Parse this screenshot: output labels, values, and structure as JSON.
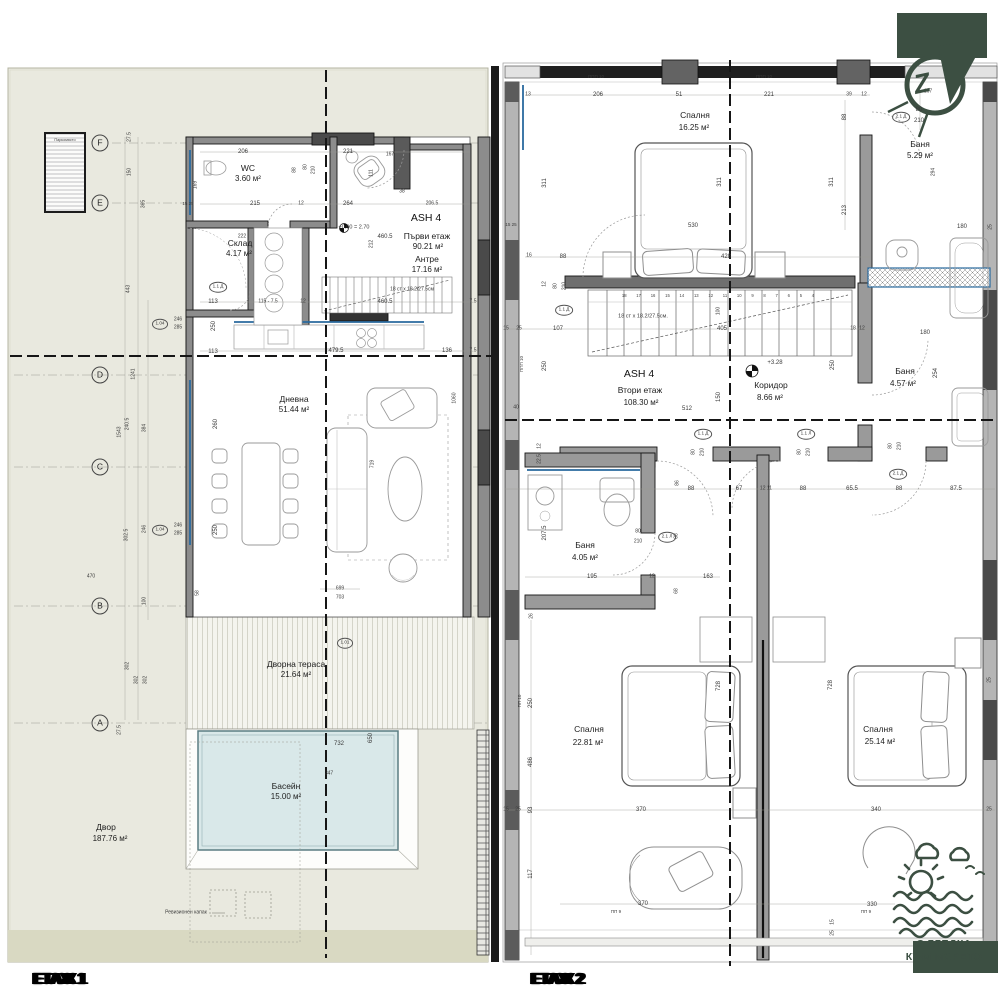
{
  "sheet": {
    "floor1_label": "ЕТАЖ 1",
    "floor2_label": "ЕТАЖ 2"
  },
  "badge": {
    "line1": "С ГЛЕДКА",
    "line2": "КЪМ МОРЕТО",
    "color": "#3c4f42"
  },
  "compass": {
    "letter": "Z",
    "nearby_dim": "167"
  },
  "left_plan": {
    "rooms": [
      {
        "t": "WC",
        "x": 248,
        "y": 168,
        "c": "room"
      },
      {
        "t": "3.60 м²",
        "x": 248,
        "y": 179,
        "c": "area"
      },
      {
        "t": "Склад",
        "x": 240,
        "y": 243,
        "c": "room"
      },
      {
        "t": "4.17 м²",
        "x": 239,
        "y": 254,
        "c": "area"
      },
      {
        "t": "ASH 4",
        "x": 426,
        "y": 218,
        "c": "big"
      },
      {
        "t": "Първи  етаж",
        "x": 427,
        "y": 236,
        "c": "room"
      },
      {
        "t": "90.21 м²",
        "x": 428,
        "y": 247,
        "c": "area"
      },
      {
        "t": "Антре",
        "x": 427,
        "y": 259,
        "c": "room"
      },
      {
        "t": "17.16 м²",
        "x": 427,
        "y": 270,
        "c": "area"
      },
      {
        "t": "Дневна",
        "x": 294,
        "y": 399,
        "c": "room"
      },
      {
        "t": "51.44 м²",
        "x": 294,
        "y": 410,
        "c": "area"
      },
      {
        "t": "Дворна тераса",
        "x": 296,
        "y": 664,
        "c": "room"
      },
      {
        "t": "21.64 м²",
        "x": 296,
        "y": 675,
        "c": "area"
      },
      {
        "t": "Басейн",
        "x": 286,
        "y": 786,
        "c": "room"
      },
      {
        "t": "15.00 м²",
        "x": 286,
        "y": 797,
        "c": "area"
      },
      {
        "t": "Двор",
        "x": 106,
        "y": 827,
        "c": "room"
      },
      {
        "t": "187.76 м²",
        "x": 110,
        "y": 839,
        "c": "area"
      },
      {
        "t": "Паркомясто",
        "x": 65,
        "y": 141,
        "s": 3.8
      },
      {
        "t": "+0.00 = 2.70",
        "x": 354,
        "y": 228,
        "s": 5.5
      },
      {
        "t": "18 ст x 18.2/27.5см",
        "x": 412,
        "y": 290,
        "s": 5
      },
      {
        "t": "Ревизионен капак",
        "x": 186,
        "y": 913,
        "s": 5
      }
    ],
    "dims": [
      {
        "t": "206",
        "x": 243,
        "y": 152
      },
      {
        "t": "167",
        "x": 390,
        "y": 155,
        "s": 5
      },
      {
        "t": "221",
        "x": 348,
        "y": 152
      },
      {
        "t": "215",
        "x": 255,
        "y": 204
      },
      {
        "t": "12",
        "x": 301,
        "y": 204,
        "s": 5
      },
      {
        "t": "264",
        "x": 348,
        "y": 204
      },
      {
        "t": "206.5",
        "x": 432,
        "y": 204,
        "s": 5
      },
      {
        "t": "38",
        "x": 402,
        "y": 192,
        "s": 5
      },
      {
        "t": "460.5",
        "x": 385,
        "y": 237
      },
      {
        "t": "212",
        "x": 372,
        "y": 244,
        "r": 90,
        "s": 5
      },
      {
        "t": "222",
        "x": 242,
        "y": 237,
        "s": 5
      },
      {
        "t": "113",
        "x": 213,
        "y": 302
      },
      {
        "t": "115 - 7.5",
        "x": 268,
        "y": 302,
        "s": 5
      },
      {
        "t": "12",
        "x": 303,
        "y": 302,
        "s": 5
      },
      {
        "t": "460.5",
        "x": 385,
        "y": 302
      },
      {
        "t": "113",
        "x": 213,
        "y": 352
      },
      {
        "t": "479.5",
        "x": 336,
        "y": 351
      },
      {
        "t": "136",
        "x": 447,
        "y": 351
      },
      {
        "t": "7.5",
        "x": 473,
        "y": 302,
        "s": 5
      },
      {
        "t": "7.5",
        "x": 473,
        "y": 351,
        "s": 5
      },
      {
        "t": "250",
        "x": 214,
        "y": 326,
        "r": 90
      },
      {
        "t": "699",
        "x": 340,
        "y": 589,
        "s": 5
      },
      {
        "t": "703",
        "x": 340,
        "y": 598,
        "s": 5
      },
      {
        "t": "260",
        "x": 216,
        "y": 424,
        "r": 90
      },
      {
        "t": "250",
        "x": 216,
        "y": 530,
        "r": 90
      },
      {
        "t": "719",
        "x": 373,
        "y": 464,
        "r": 90,
        "s": 5
      },
      {
        "t": "1060",
        "x": 455,
        "y": 398,
        "r": 90,
        "s": 5
      },
      {
        "t": "58",
        "x": 198,
        "y": 593,
        "r": 90,
        "s": 5
      },
      {
        "t": "732",
        "x": 339,
        "y": 744
      },
      {
        "t": "650",
        "x": 371,
        "y": 738,
        "r": 90
      },
      {
        "t": "347",
        "x": 329,
        "y": 774,
        "s": 5
      },
      {
        "t": "302",
        "x": 128,
        "y": 666,
        "r": 90,
        "s": 5
      },
      {
        "t": "302",
        "x": 137,
        "y": 680,
        "r": 90,
        "s": 5
      },
      {
        "t": "302",
        "x": 146,
        "y": 680,
        "r": 90,
        "s": 5
      },
      {
        "t": "470",
        "x": 91,
        "y": 577,
        "s": 5
      },
      {
        "t": "27.5",
        "x": 130,
        "y": 137,
        "r": 90,
        "s": 5
      },
      {
        "t": "150",
        "x": 130,
        "y": 172,
        "r": 90,
        "s": 5
      },
      {
        "t": "365",
        "x": 144,
        "y": 204,
        "r": 90,
        "s": 5
      },
      {
        "t": "443",
        "x": 129,
        "y": 289,
        "r": 90,
        "s": 5
      },
      {
        "t": "1241",
        "x": 134,
        "y": 374,
        "r": 90,
        "s": 5
      },
      {
        "t": "1543",
        "x": 120,
        "y": 432,
        "r": 90,
        "s": 5
      },
      {
        "t": "240.5",
        "x": 128,
        "y": 424,
        "r": 90,
        "s": 5
      },
      {
        "t": "384",
        "x": 145,
        "y": 428,
        "r": 90,
        "s": 5
      },
      {
        "t": "302.5",
        "x": 127,
        "y": 535,
        "r": 90,
        "s": 5
      },
      {
        "t": "246",
        "x": 145,
        "y": 529,
        "r": 90,
        "s": 5
      },
      {
        "t": "100",
        "x": 145,
        "y": 601,
        "r": 90,
        "s": 5
      },
      {
        "t": "246",
        "x": 178,
        "y": 320,
        "s": 5
      },
      {
        "t": "285",
        "x": 178,
        "y": 328,
        "s": 5
      },
      {
        "t": "246",
        "x": 178,
        "y": 526,
        "s": 5
      },
      {
        "t": "285",
        "x": 178,
        "y": 534,
        "s": 5
      },
      {
        "t": "88",
        "x": 295,
        "y": 170,
        "r": 90,
        "s": 5
      },
      {
        "t": "80",
        "x": 306,
        "y": 167,
        "r": 90,
        "s": 5
      },
      {
        "t": "210",
        "x": 314,
        "y": 170,
        "r": 90,
        "s": 5
      },
      {
        "t": "169",
        "x": 196,
        "y": 185,
        "r": 90,
        "s": 5
      },
      {
        "t": "111",
        "x": 372,
        "y": 173,
        "r": 90,
        "s": 5
      },
      {
        "t": "15 25",
        "x": 188,
        "y": 204,
        "s": 4.5
      },
      {
        "t": "27.5",
        "x": 120,
        "y": 730,
        "r": 90,
        "s": 5
      }
    ],
    "bubbles": [
      {
        "t": "F",
        "x": 100,
        "y": 143,
        "c": "gbub"
      },
      {
        "t": "E",
        "x": 100,
        "y": 203,
        "c": "gbub"
      },
      {
        "t": "D",
        "x": 100,
        "y": 375,
        "c": "gbub"
      },
      {
        "t": "C",
        "x": 100,
        "y": 467,
        "c": "gbub"
      },
      {
        "t": "B",
        "x": 100,
        "y": 606,
        "c": "gbub"
      },
      {
        "t": "A",
        "x": 100,
        "y": 723,
        "c": "gbub"
      },
      {
        "t": "1.04",
        "x": 160,
        "y": 324
      },
      {
        "t": "1.04",
        "x": 160,
        "y": 530
      },
      {
        "t": "1.1 Д",
        "x": 218,
        "y": 287
      },
      {
        "t": "1.01",
        "x": 345,
        "y": 643
      }
    ]
  },
  "right_plan": {
    "rooms": [
      {
        "t": "Спалня",
        "x": 695,
        "y": 115,
        "c": "room"
      },
      {
        "t": "16.25 м²",
        "x": 694,
        "y": 128,
        "c": "area"
      },
      {
        "t": "Баня",
        "x": 920,
        "y": 144,
        "c": "room"
      },
      {
        "t": "5.29 м²",
        "x": 920,
        "y": 156,
        "c": "area"
      },
      {
        "t": "ASH 4",
        "x": 639,
        "y": 374,
        "c": "big"
      },
      {
        "t": "Втори  етаж",
        "x": 640,
        "y": 390,
        "c": "room"
      },
      {
        "t": "108.30 м²",
        "x": 641,
        "y": 403,
        "c": "area"
      },
      {
        "t": "+3.28",
        "x": 775,
        "y": 363,
        "s": 6
      },
      {
        "t": "Коридор",
        "x": 771,
        "y": 385,
        "c": "room"
      },
      {
        "t": "8.66 м²",
        "x": 770,
        "y": 398,
        "c": "area"
      },
      {
        "t": "Баня",
        "x": 905,
        "y": 371,
        "c": "room"
      },
      {
        "t": "4.57 м²",
        "x": 903,
        "y": 384,
        "c": "area"
      },
      {
        "t": "Баня",
        "x": 585,
        "y": 545,
        "c": "room"
      },
      {
        "t": "4.05 м²",
        "x": 585,
        "y": 558,
        "c": "area"
      },
      {
        "t": "Спалня",
        "x": 589,
        "y": 729,
        "c": "room"
      },
      {
        "t": "22.81 м²",
        "x": 588,
        "y": 743,
        "c": "area"
      },
      {
        "t": "Спалня",
        "x": 878,
        "y": 729,
        "c": "room"
      },
      {
        "t": "25.14 м²",
        "x": 880,
        "y": 742,
        "c": "area"
      },
      {
        "t": "18 ст x 18.2/27.5см.",
        "x": 643,
        "y": 317,
        "s": 5.5
      },
      {
        "t": "18 17 16 15 14 13 12 11 10 9 8 7 6 5 4",
        "x": 718,
        "y": 296,
        "c": "wsp"
      }
    ],
    "dims": [
      {
        "t": "206",
        "x": 598,
        "y": 95
      },
      {
        "t": "51",
        "x": 679,
        "y": 95
      },
      {
        "t": "221",
        "x": 769,
        "y": 95
      },
      {
        "t": "39",
        "x": 849,
        "y": 95,
        "s": 5
      },
      {
        "t": "12",
        "x": 864,
        "y": 95,
        "s": 5
      },
      {
        "t": "13",
        "x": 528,
        "y": 95,
        "s": 5
      },
      {
        "t": "167",
        "x": 928,
        "y": 92,
        "s": 5
      },
      {
        "t": "ППП 10",
        "x": 596,
        "y": 77,
        "s": 4.5
      },
      {
        "t": "ППП 10",
        "x": 764,
        "y": 77,
        "s": 4.5
      },
      {
        "t": "ППП 10",
        "x": 522,
        "y": 364,
        "r": 90,
        "s": 4.5
      },
      {
        "t": "ПП 10",
        "x": 520,
        "y": 701,
        "r": 90,
        "s": 4.5
      },
      {
        "t": "ПП 9",
        "x": 616,
        "y": 912,
        "s": 4.5
      },
      {
        "t": "ПП 9",
        "x": 866,
        "y": 912,
        "s": 4.5
      },
      {
        "t": "311",
        "x": 545,
        "y": 183,
        "r": 90
      },
      {
        "t": "311",
        "x": 720,
        "y": 182,
        "r": 90
      },
      {
        "t": "311",
        "x": 832,
        "y": 182,
        "r": 90
      },
      {
        "t": "213",
        "x": 845,
        "y": 210,
        "r": 90
      },
      {
        "t": "88",
        "x": 845,
        "y": 117,
        "r": 90
      },
      {
        "t": "80",
        "x": 919,
        "y": 110
      },
      {
        "t": "210",
        "x": 919,
        "y": 121
      },
      {
        "t": "180",
        "x": 962,
        "y": 227
      },
      {
        "t": "25",
        "x": 991,
        "y": 227,
        "r": 90,
        "s": 5
      },
      {
        "t": "294",
        "x": 934,
        "y": 172,
        "r": 90,
        "s": 5
      },
      {
        "t": "180",
        "x": 925,
        "y": 333
      },
      {
        "t": "254",
        "x": 936,
        "y": 373,
        "r": 90
      },
      {
        "t": "530",
        "x": 693,
        "y": 226
      },
      {
        "t": "428",
        "x": 726,
        "y": 257
      },
      {
        "t": "88",
        "x": 563,
        "y": 257
      },
      {
        "t": "16",
        "x": 529,
        "y": 256,
        "s": 5
      },
      {
        "t": "15 25",
        "x": 511,
        "y": 225,
        "s": 4.5
      },
      {
        "t": "12",
        "x": 545,
        "y": 284,
        "r": 90,
        "s": 5
      },
      {
        "t": "80",
        "x": 556,
        "y": 286,
        "r": 90,
        "s": 5
      },
      {
        "t": "210",
        "x": 565,
        "y": 286,
        "r": 90,
        "s": 5
      },
      {
        "t": "107",
        "x": 558,
        "y": 329
      },
      {
        "t": "405",
        "x": 722,
        "y": 329
      },
      {
        "t": "100",
        "x": 719,
        "y": 311,
        "r": 90,
        "s": 5
      },
      {
        "t": "15",
        "x": 506,
        "y": 329,
        "s": 5
      },
      {
        "t": "25",
        "x": 519,
        "y": 329,
        "s": 5
      },
      {
        "t": "18",
        "x": 853,
        "y": 329,
        "s": 5
      },
      {
        "t": "12",
        "x": 862,
        "y": 329,
        "s": 5
      },
      {
        "t": "512",
        "x": 687,
        "y": 409
      },
      {
        "t": "150",
        "x": 719,
        "y": 397,
        "r": 90
      },
      {
        "t": "250",
        "x": 833,
        "y": 365,
        "r": 90
      },
      {
        "t": "250",
        "x": 545,
        "y": 366,
        "r": 90
      },
      {
        "t": "40",
        "x": 516,
        "y": 408,
        "s": 5
      },
      {
        "t": "86",
        "x": 678,
        "y": 483,
        "r": 90,
        "s": 5
      },
      {
        "t": "88",
        "x": 691,
        "y": 489
      },
      {
        "t": "67",
        "x": 739,
        "y": 489
      },
      {
        "t": "12 11",
        "x": 766,
        "y": 489,
        "s": 5
      },
      {
        "t": "88",
        "x": 803,
        "y": 489
      },
      {
        "t": "65.5",
        "x": 852,
        "y": 489
      },
      {
        "t": "88",
        "x": 899,
        "y": 489
      },
      {
        "t": "87.5",
        "x": 956,
        "y": 489
      },
      {
        "t": "80",
        "x": 694,
        "y": 452,
        "r": 90,
        "s": 5
      },
      {
        "t": "210",
        "x": 703,
        "y": 452,
        "r": 90,
        "s": 5
      },
      {
        "t": "80",
        "x": 800,
        "y": 452,
        "r": 90,
        "s": 5
      },
      {
        "t": "210",
        "x": 809,
        "y": 452,
        "r": 90,
        "s": 5
      },
      {
        "t": "80",
        "x": 891,
        "y": 446,
        "r": 90,
        "s": 5
      },
      {
        "t": "210",
        "x": 900,
        "y": 446,
        "r": 90,
        "s": 5
      },
      {
        "t": "22.5",
        "x": 540,
        "y": 459,
        "r": 90,
        "s": 5
      },
      {
        "t": "12",
        "x": 540,
        "y": 446,
        "r": 90,
        "s": 5
      },
      {
        "t": "207.5",
        "x": 545,
        "y": 533,
        "r": 90
      },
      {
        "t": "195",
        "x": 592,
        "y": 577
      },
      {
        "t": "12",
        "x": 652,
        "y": 577,
        "s": 5
      },
      {
        "t": "163",
        "x": 708,
        "y": 577
      },
      {
        "t": "68",
        "x": 677,
        "y": 591,
        "r": 90,
        "s": 5
      },
      {
        "t": "88",
        "x": 677,
        "y": 536,
        "r": 90,
        "s": 5
      },
      {
        "t": "80",
        "x": 638,
        "y": 532,
        "s": 5
      },
      {
        "t": "210",
        "x": 638,
        "y": 542,
        "s": 5
      },
      {
        "t": "26",
        "x": 532,
        "y": 616,
        "r": 90,
        "s": 5
      },
      {
        "t": "250",
        "x": 531,
        "y": 703,
        "r": 90
      },
      {
        "t": "486",
        "x": 531,
        "y": 762,
        "r": 90
      },
      {
        "t": "93",
        "x": 531,
        "y": 810,
        "r": 90
      },
      {
        "t": "117",
        "x": 531,
        "y": 874,
        "r": 90
      },
      {
        "t": "370",
        "x": 641,
        "y": 810
      },
      {
        "t": "370",
        "x": 643,
        "y": 904
      },
      {
        "t": "340",
        "x": 876,
        "y": 810
      },
      {
        "t": "330",
        "x": 872,
        "y": 905
      },
      {
        "t": "728",
        "x": 719,
        "y": 686,
        "r": 90
      },
      {
        "t": "728",
        "x": 831,
        "y": 685,
        "r": 90
      },
      {
        "t": "25",
        "x": 990,
        "y": 680,
        "r": 90,
        "s": 5
      },
      {
        "t": "25",
        "x": 989,
        "y": 810,
        "s": 5
      },
      {
        "t": "15",
        "x": 506,
        "y": 810,
        "s": 5
      },
      {
        "t": "25",
        "x": 518,
        "y": 810,
        "s": 5
      },
      {
        "t": "15",
        "x": 833,
        "y": 922,
        "r": 90,
        "s": 5
      },
      {
        "t": "25",
        "x": 833,
        "y": 933,
        "r": 90,
        "s": 5
      }
    ],
    "bubbles": [
      {
        "t": "1.1 Д",
        "x": 564,
        "y": 310
      },
      {
        "t": "1.1 Д",
        "x": 703,
        "y": 434
      },
      {
        "t": "1.1 Л",
        "x": 806,
        "y": 434
      },
      {
        "t": "2.1 Д",
        "x": 898,
        "y": 474
      },
      {
        "t": "2.1 Д",
        "x": 901,
        "y": 117
      },
      {
        "t": "2.1 Л",
        "x": 667,
        "y": 537
      }
    ]
  }
}
